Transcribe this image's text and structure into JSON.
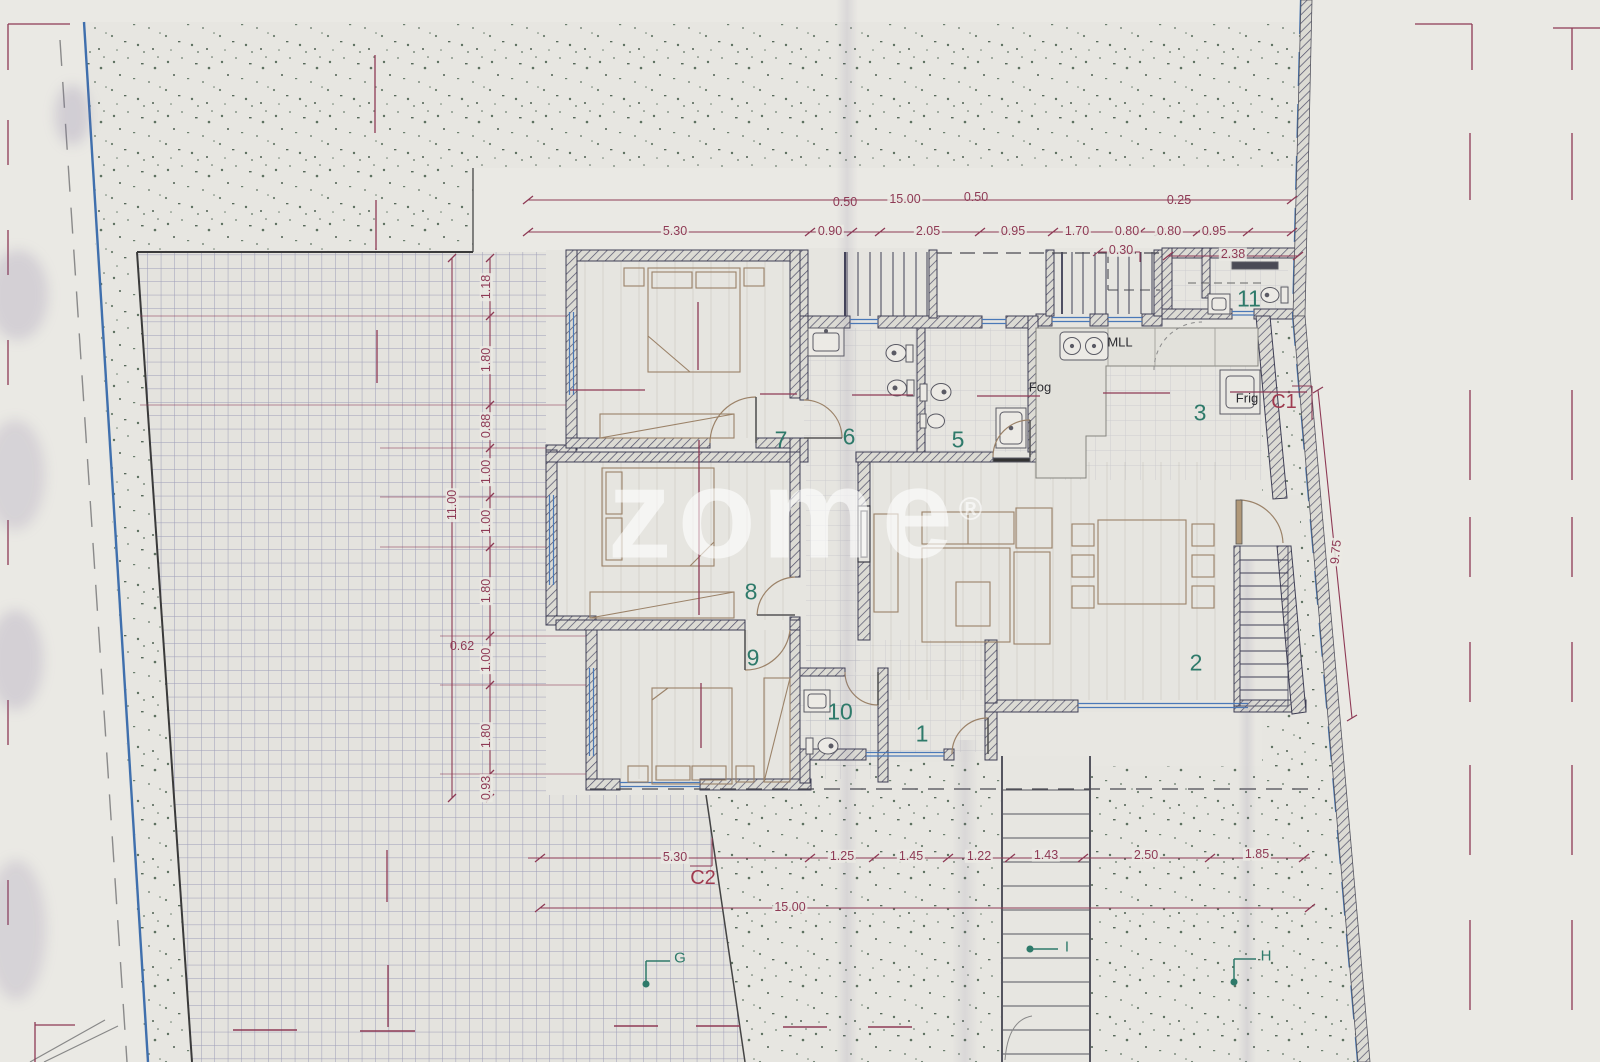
{
  "watermark": {
    "text": "zome",
    "reg": "®"
  },
  "dims": {
    "top": {
      "overall": "15.00",
      "row": [
        "5.30",
        "0.90",
        "2.05",
        "0.95",
        "1.70",
        "0.80",
        "0.80",
        "0.95"
      ],
      "above": [
        "0.50",
        "0.50",
        "0.25"
      ],
      "offsets": [
        "0.30",
        "2.38"
      ]
    },
    "left": {
      "overall": "11.00",
      "chain": [
        "1.18",
        "1.80",
        "0.88",
        "1.00",
        "1.00",
        "1.80",
        "1.00",
        "1.80",
        "0.93"
      ],
      "aside": "0.62"
    },
    "bottom": {
      "overall": "15.00",
      "chain": [
        "5.30",
        "1.25",
        "1.45",
        "1.22",
        "1.43",
        "2.50",
        "1.85"
      ]
    },
    "right": {
      "length": "9.75"
    }
  },
  "sections": {
    "c1": "C1",
    "c2": "C2"
  },
  "markers": {
    "g": "G",
    "i": "I",
    "h": "H"
  },
  "rooms": {
    "r1": "1",
    "r2": "2",
    "r3": "3",
    "r5": "5",
    "r6": "6",
    "r7": "7",
    "r8": "8",
    "r9": "9",
    "r10": "10",
    "r11": "11"
  },
  "appliances": {
    "mll": "MLL",
    "fog": "Fog",
    "frig": "Frig"
  },
  "colors": {
    "dimension": "#8e3a55",
    "room_number": "#2e7a6a",
    "wall": "#3e3e54",
    "boundary_blue": "#3f6fad",
    "window_blue": "#4a79b8",
    "terrain_dot": "#5e7160"
  }
}
